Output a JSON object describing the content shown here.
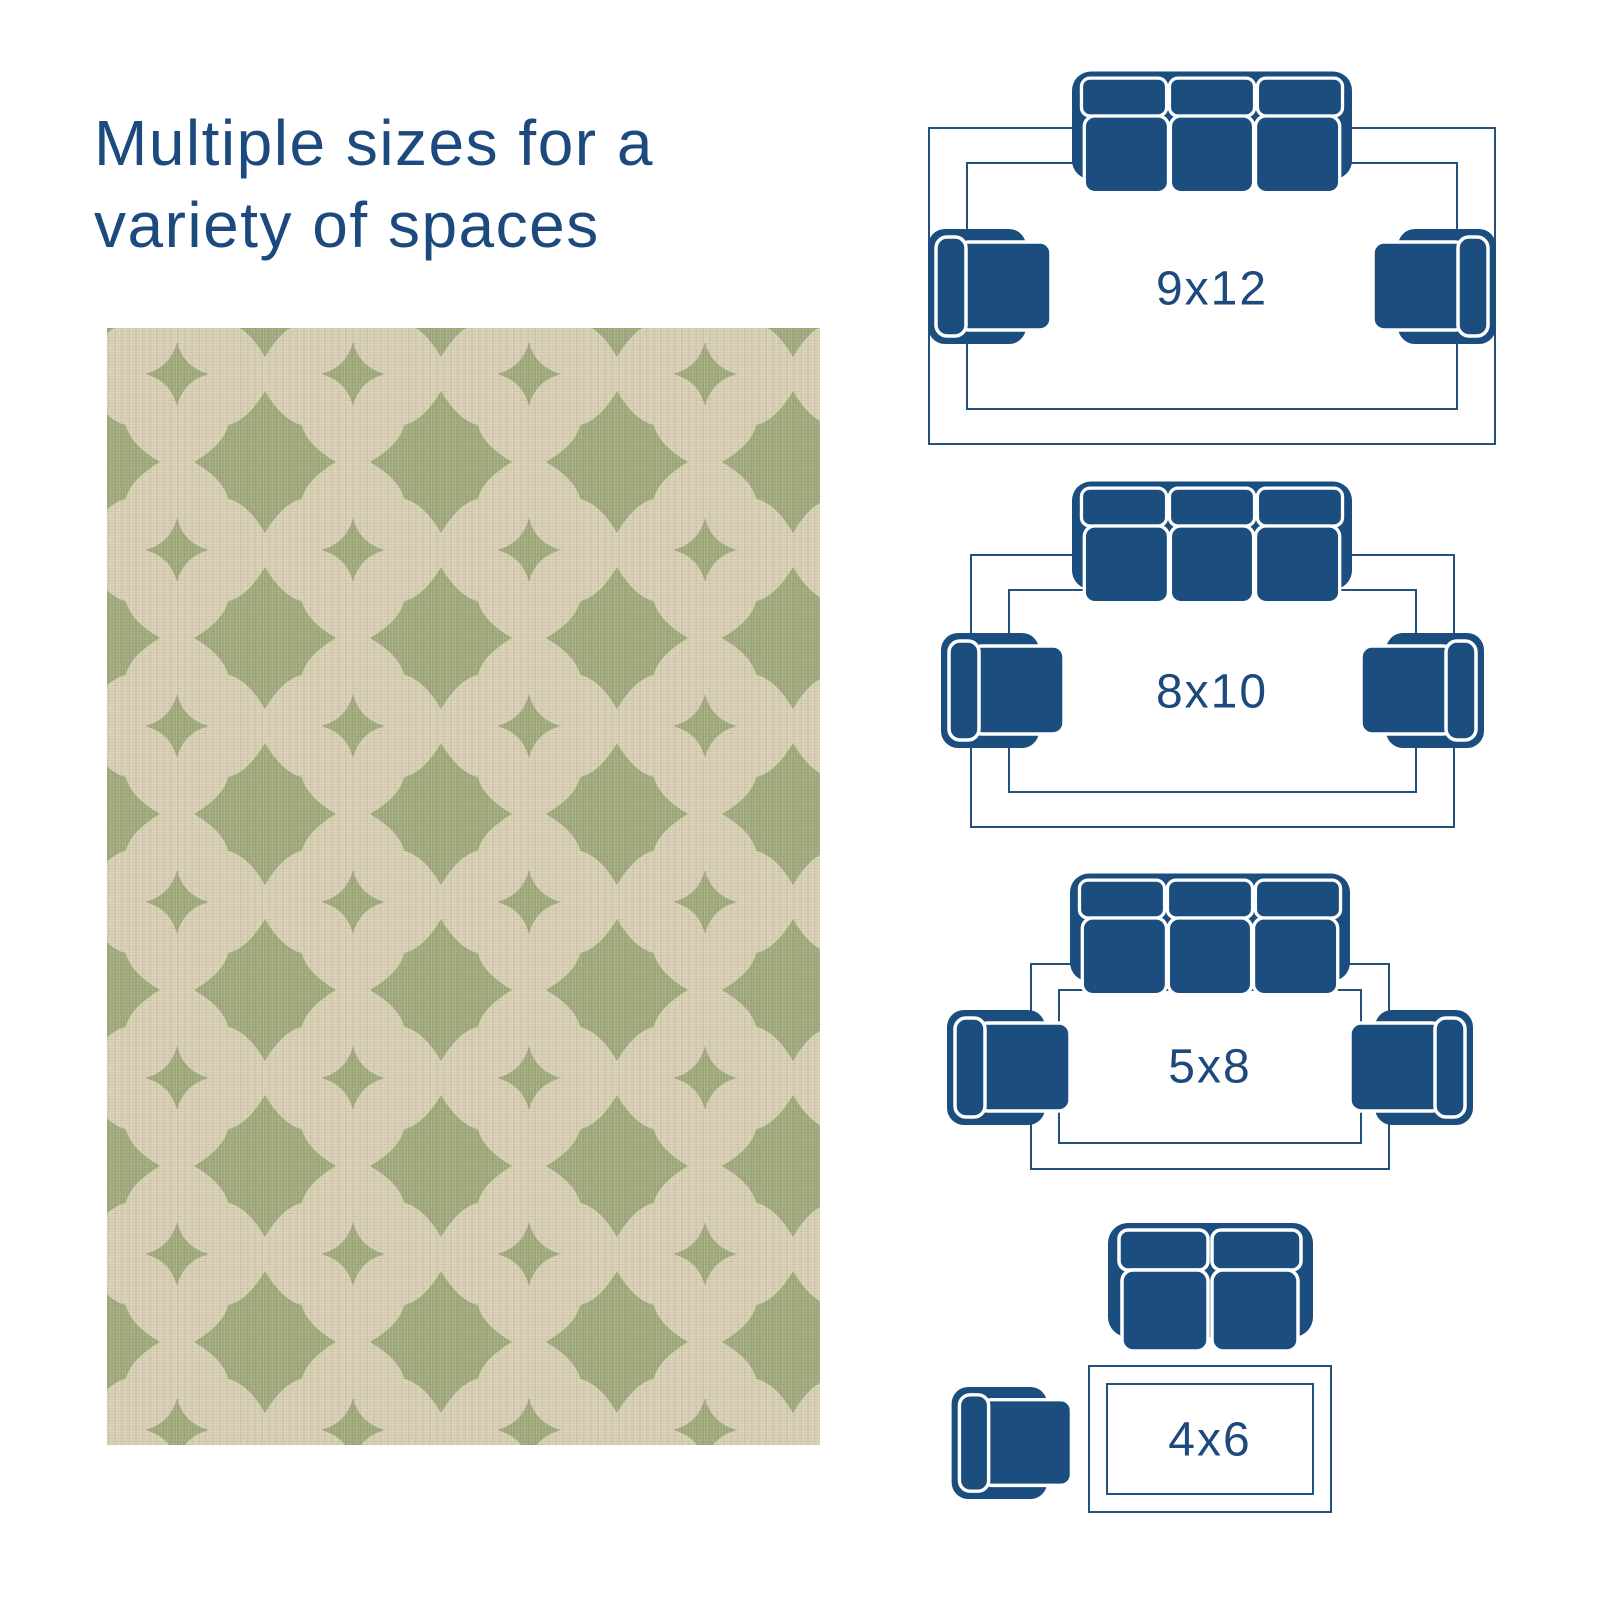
{
  "title": {
    "line1": "Multiple sizes for a",
    "line2": "variety of spaces"
  },
  "rug_sizes": [
    {
      "label": "9x12",
      "furniture": "three-seat-sofa, two armchairs"
    },
    {
      "label": "8x10",
      "furniture": "three-seat-sofa, two armchairs"
    },
    {
      "label": "5x8",
      "furniture": "three-seat-sofa, two armchairs"
    },
    {
      "label": "4x6",
      "furniture": "two-seat-loveseat, one armchair"
    }
  ],
  "colors": {
    "furniture_navy": "#1b4e7e",
    "outline_navy": "#24507c",
    "text_navy": "#1d4a7e",
    "rug_green": "#a2ab7d",
    "rug_cream": "#d9d0b6",
    "background": "#ffffff"
  },
  "icons": [
    "sofa-icon",
    "loveseat-icon",
    "armchair-icon"
  ],
  "rug": {
    "description": "sage green and beige quatrefoil trellis flatweave rug"
  }
}
